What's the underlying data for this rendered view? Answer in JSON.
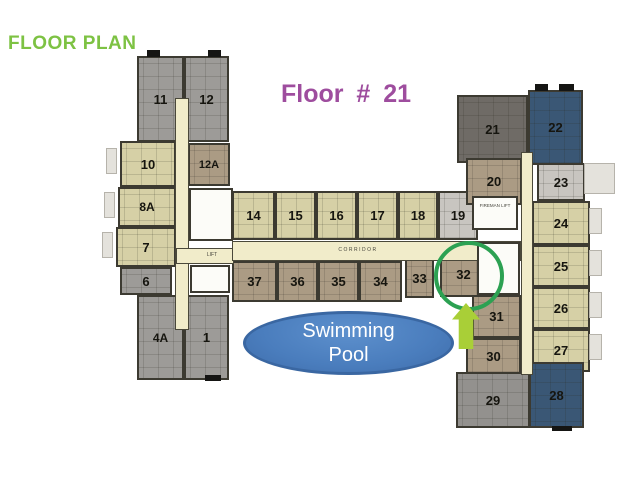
{
  "header": {
    "title": "FLOOR PLAN",
    "floor_label": "Floor # 21"
  },
  "pool": {
    "line1": "Swimming",
    "line2": "Pool"
  },
  "annotations": {
    "highlighted_unit": "32",
    "arrow_icon": "up-arrow"
  },
  "colors": {
    "tan": "#d6d0a6",
    "brown": "#ab9b84",
    "gray": "#9d9b98",
    "dark_gray": "#6f6b66",
    "dark_blue": "#3a5775",
    "light_gray": "#c8c5c0",
    "mid_gray": "#93918e",
    "title_green": "#7dc243",
    "title_purple": "#9e4d9e",
    "corridor_cream": "#f1ecca",
    "pool_blue": "#4a7dbd",
    "circle_green": "#2ca152",
    "arrow_green": "#a9cf37"
  },
  "plan": {
    "units": [
      {
        "label": "11",
        "fill": "gray",
        "x": 137,
        "y": 56,
        "w": 47,
        "h": 86
      },
      {
        "label": "12",
        "fill": "gray",
        "x": 184,
        "y": 56,
        "w": 45,
        "h": 86
      },
      {
        "label": "10",
        "fill": "tan",
        "x": 120,
        "y": 141,
        "w": 56,
        "h": 46
      },
      {
        "label": "12A",
        "fill": "brown",
        "x": 188,
        "y": 143,
        "w": 42,
        "h": 43,
        "fs": 11
      },
      {
        "label": "8A",
        "fill": "tan",
        "x": 118,
        "y": 187,
        "w": 58,
        "h": 40,
        "fs": 12
      },
      {
        "label": "7",
        "fill": "tan",
        "x": 116,
        "y": 227,
        "w": 60,
        "h": 40
      },
      {
        "label": "6",
        "fill": "gray",
        "x": 120,
        "y": 267,
        "w": 52,
        "h": 28
      },
      {
        "label": "4A",
        "fill": "gray",
        "x": 137,
        "y": 295,
        "w": 47,
        "h": 85,
        "fs": 12
      },
      {
        "label": "1",
        "fill": "gray",
        "x": 184,
        "y": 295,
        "w": 45,
        "h": 85
      },
      {
        "label": "14",
        "fill": "tan",
        "x": 232,
        "y": 191,
        "w": 43,
        "h": 49
      },
      {
        "label": "15",
        "fill": "tan",
        "x": 275,
        "y": 191,
        "w": 41,
        "h": 49
      },
      {
        "label": "16",
        "fill": "tan",
        "x": 316,
        "y": 191,
        "w": 41,
        "h": 49
      },
      {
        "label": "17",
        "fill": "tan",
        "x": 357,
        "y": 191,
        "w": 41,
        "h": 49
      },
      {
        "label": "18",
        "fill": "tan",
        "x": 398,
        "y": 191,
        "w": 40,
        "h": 49
      },
      {
        "label": "19",
        "fill": "light_gray",
        "x": 438,
        "y": 191,
        "w": 40,
        "h": 49
      },
      {
        "label": "37",
        "fill": "brown",
        "x": 232,
        "y": 261,
        "w": 45,
        "h": 41
      },
      {
        "label": "36",
        "fill": "brown",
        "x": 277,
        "y": 261,
        "w": 41,
        "h": 41
      },
      {
        "label": "35",
        "fill": "brown",
        "x": 318,
        "y": 261,
        "w": 41,
        "h": 41
      },
      {
        "label": "34",
        "fill": "brown",
        "x": 359,
        "y": 261,
        "w": 43,
        "h": 41
      },
      {
        "label": "33",
        "fill": "brown",
        "x": 405,
        "y": 259,
        "w": 29,
        "h": 39
      },
      {
        "label": "32",
        "fill": "brown",
        "x": 440,
        "y": 252,
        "w": 47,
        "h": 45
      },
      {
        "label": "21",
        "fill": "dark_gray",
        "x": 457,
        "y": 95,
        "w": 71,
        "h": 68
      },
      {
        "label": "22",
        "fill": "dark_blue",
        "x": 528,
        "y": 90,
        "w": 55,
        "h": 75
      },
      {
        "label": "20",
        "fill": "brown",
        "x": 466,
        "y": 158,
        "w": 56,
        "h": 47
      },
      {
        "label": "23",
        "fill": "light_gray",
        "x": 537,
        "y": 163,
        "w": 48,
        "h": 38
      },
      {
        "label": "24",
        "fill": "tan",
        "x": 532,
        "y": 201,
        "w": 58,
        "h": 44
      },
      {
        "label": "25",
        "fill": "tan",
        "x": 532,
        "y": 245,
        "w": 58,
        "h": 42
      },
      {
        "label": "26",
        "fill": "tan",
        "x": 532,
        "y": 287,
        "w": 58,
        "h": 42
      },
      {
        "label": "27",
        "fill": "tan",
        "x": 532,
        "y": 329,
        "w": 58,
        "h": 43
      },
      {
        "label": "31",
        "fill": "brown",
        "x": 472,
        "y": 295,
        "w": 49,
        "h": 43
      },
      {
        "label": "30",
        "fill": "brown",
        "x": 466,
        "y": 338,
        "w": 55,
        "h": 37
      },
      {
        "label": "29",
        "fill": "mid_gray",
        "x": 456,
        "y": 372,
        "w": 74,
        "h": 56
      },
      {
        "label": "28",
        "fill": "dark_blue",
        "x": 529,
        "y": 362,
        "w": 55,
        "h": 66
      }
    ],
    "corridors": [
      {
        "x": 175,
        "y": 98,
        "w": 14,
        "h": 232
      },
      {
        "x": 176,
        "y": 248,
        "w": 58,
        "h": 16
      },
      {
        "x": 232,
        "y": 241,
        "w": 289,
        "h": 20
      },
      {
        "x": 521,
        "y": 152,
        "w": 12,
        "h": 223
      }
    ],
    "service_blocks": [
      {
        "x": 189,
        "y": 188,
        "w": 44,
        "h": 53
      },
      {
        "x": 190,
        "y": 265,
        "w": 40,
        "h": 28
      },
      {
        "x": 472,
        "y": 196,
        "w": 46,
        "h": 34
      },
      {
        "x": 477,
        "y": 242,
        "w": 43,
        "h": 53
      }
    ],
    "decor_tabs": [
      {
        "x": 147,
        "y": 50,
        "w": 13,
        "h": 7
      },
      {
        "x": 208,
        "y": 50,
        "w": 13,
        "h": 7
      },
      {
        "x": 535,
        "y": 84,
        "w": 13,
        "h": 7
      },
      {
        "x": 559,
        "y": 84,
        "w": 15,
        "h": 7
      },
      {
        "x": 205,
        "y": 375,
        "w": 16,
        "h": 6
      },
      {
        "x": 552,
        "y": 426,
        "w": 20,
        "h": 5
      }
    ],
    "balconies": [
      {
        "x": 584,
        "y": 163,
        "w": 31,
        "h": 31
      },
      {
        "x": 589,
        "y": 208,
        "w": 13,
        "h": 26
      },
      {
        "x": 589,
        "y": 250,
        "w": 13,
        "h": 26
      },
      {
        "x": 589,
        "y": 292,
        "w": 13,
        "h": 26
      },
      {
        "x": 589,
        "y": 334,
        "w": 13,
        "h": 26
      },
      {
        "x": 106,
        "y": 148,
        "w": 11,
        "h": 26
      },
      {
        "x": 104,
        "y": 192,
        "w": 11,
        "h": 26
      },
      {
        "x": 102,
        "y": 232,
        "w": 11,
        "h": 26
      }
    ],
    "labels": [
      {
        "text": "LIFT",
        "x": 190,
        "y": 252,
        "w": 44,
        "size": 5
      },
      {
        "text": "CORRIDOR",
        "x": 322,
        "y": 247,
        "w": 72,
        "size": 5,
        "ls": 1.5
      },
      {
        "text": "FIREMAN LIFT",
        "x": 474,
        "y": 203,
        "w": 42,
        "size": 4.5
      }
    ]
  }
}
